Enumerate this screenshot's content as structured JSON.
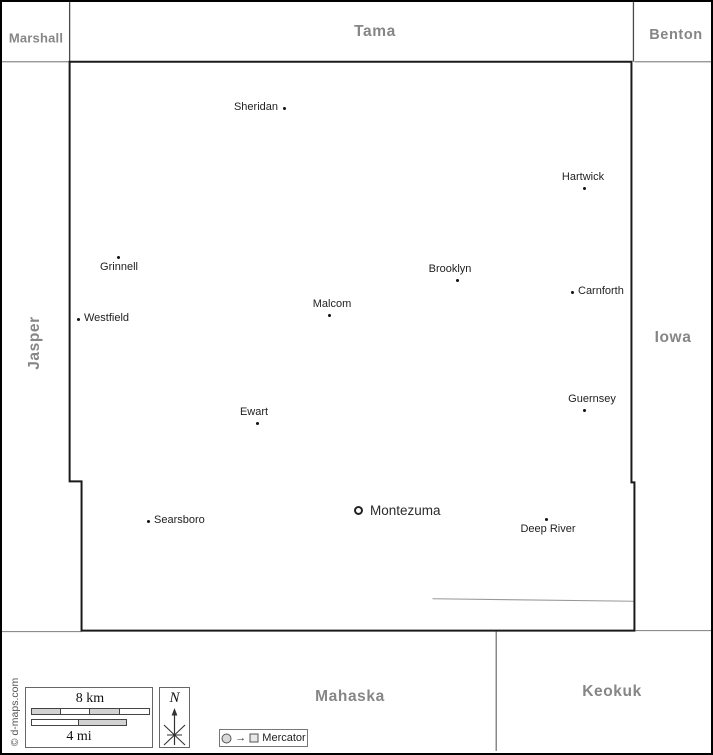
{
  "neighbor_counties": {
    "marshall": "Marshall",
    "tama": "Tama",
    "benton": "Benton",
    "jasper": "Jasper",
    "iowa": "Iowa",
    "mahaska": "Mahaska",
    "keokuk": "Keokuk"
  },
  "towns": [
    {
      "name": "Sheridan",
      "x": 282,
      "y": 106,
      "label": "left"
    },
    {
      "name": "Hartwick",
      "x": 582,
      "y": 186,
      "label": "above",
      "lx": 581
    },
    {
      "name": "Grinnell",
      "x": 116,
      "y": 255,
      "label": "below",
      "lx": 117
    },
    {
      "name": "Brooklyn",
      "x": 455,
      "y": 278,
      "label": "above",
      "lx": 448
    },
    {
      "name": "Carnforth",
      "x": 570,
      "y": 290,
      "label": "right"
    },
    {
      "name": "Westfield",
      "x": 76,
      "y": 317,
      "label": "right"
    },
    {
      "name": "Malcom",
      "x": 327,
      "y": 313,
      "label": "above",
      "lx": 330
    },
    {
      "name": "Guernsey",
      "x": 582,
      "y": 408,
      "label": "above",
      "lx": 590
    },
    {
      "name": "Ewart",
      "x": 255,
      "y": 421,
      "label": "above",
      "lx": 252
    },
    {
      "name": "Searsboro",
      "x": 146,
      "y": 519,
      "label": "right"
    },
    {
      "name": "Montezuma",
      "x": 357,
      "y": 509,
      "label": "right",
      "seat": true
    },
    {
      "name": "Deep River",
      "x": 544,
      "y": 517,
      "label": "below",
      "lx": 546
    }
  ],
  "legend": {
    "km_label": "8 km",
    "mi_label": "4 mi",
    "north_label": "N",
    "projection": "Mercator"
  },
  "copyright": "© d-maps.com",
  "colors": {
    "county_border": "#1a1a1a",
    "neighbor_border": "#8c8c8c",
    "county_label": "#868686",
    "town_label": "#222222",
    "scale_fill": "#d2d2d2",
    "background": "#ffffff"
  }
}
